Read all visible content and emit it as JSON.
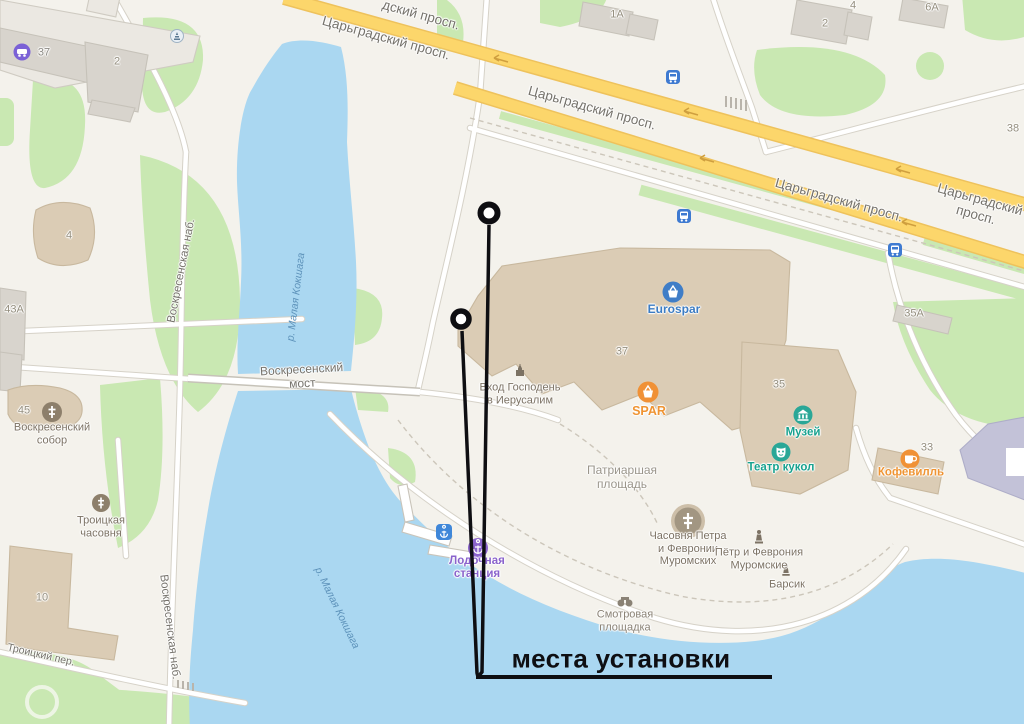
{
  "map": {
    "streets": {
      "tsar_top_partial": "дский просп.",
      "tsargradsky": "Царьградский просп.",
      "voskresenskaya_nab": "Воскресенская наб.",
      "voskresensky_most": "Воскресенский\nмост",
      "troitsky_per": "Троицкий пер."
    },
    "river": {
      "name": "р. Малая Кокшага"
    },
    "numbers": {
      "n37": "37",
      "n2": "2",
      "n4": "4",
      "n43a": "43А",
      "n45": "45",
      "n10": "10",
      "n1a": "1А",
      "n6a": "6А",
      "n38": "38",
      "n35a": "35А",
      "n35": "35",
      "n33": "33"
    },
    "pois": {
      "eurospar": "Eurospar",
      "spar": "SPAR",
      "vhod": "Вход Господень\nв Иерусалим",
      "muzey": "Музей",
      "teatr": "Театр кукол",
      "kofeville": "Кофевилль",
      "chasovnya_petra": "Часовня Петра\nи Февронии\nМуромских",
      "petr_fevronia": "Пётр и Феврония\nМуромские",
      "barsik": "Барсик",
      "smotrovaya": "Смотровая\nплощадка",
      "patriarshaya": "Патриаршая\nплощадь",
      "lodochnaya": "Лодочная\nстанция",
      "sobor": "Воскресенский\nсобор",
      "troitskaya": "Троицкая\nчасовня"
    }
  },
  "annotation": {
    "label": "места установки"
  },
  "palette": {
    "land": "#f4f2ec",
    "water": "#aad7f1",
    "park": "#c9e8b2",
    "highway": "#fcd66b",
    "building_tan": "#dbccb5",
    "building_gray": "#ddd8d1",
    "annotation": "#0e0e12",
    "poi_teal": "#18a28f",
    "poi_orange": "#ef9433",
    "poi_blue": "#3c7cc3",
    "poi_purple": "#8a63cc",
    "transport_blue": "#3e7ad1"
  }
}
